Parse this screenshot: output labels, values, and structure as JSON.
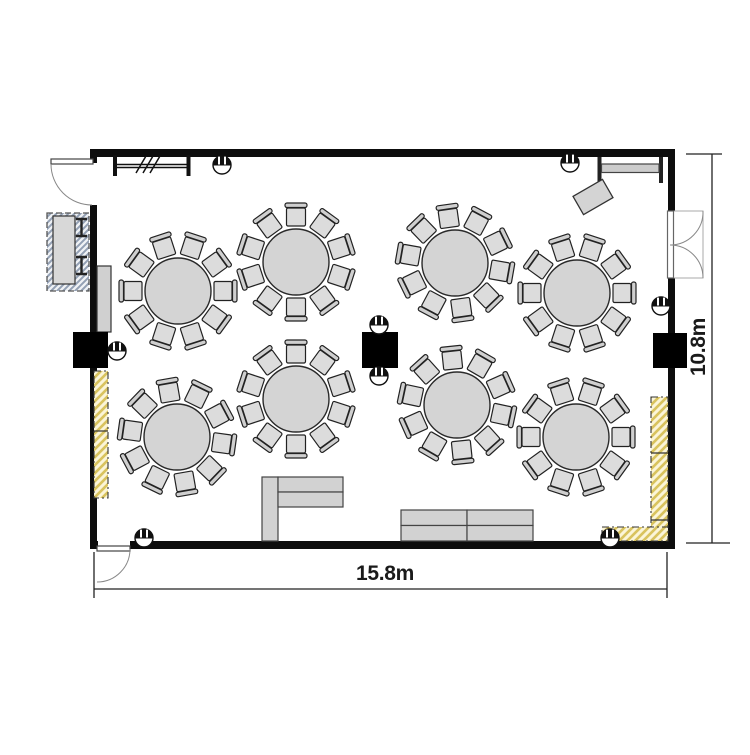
{
  "dimensions": {
    "width_label": "15.8m",
    "height_label": "10.8m"
  },
  "summary": {
    "round_tables": 8,
    "chairs_per_table": 10
  },
  "colors": {
    "wall": "#0d0d0d",
    "table_fill": "#d4d4d4",
    "chair_fill": "#dcdcdc",
    "chair_back_fill": "#cfcfcf",
    "sofa_fill": "#d2d2d2",
    "outline": "#222222",
    "yellow_hatch_bg": "#fbf5d8",
    "yellow_hatch_line": "#d9c35e",
    "blue_hatch_bg": "#f0f2f5",
    "blue_hatch_line": "#93a0b4"
  },
  "plan": {
    "canvas": {
      "w": 750,
      "h": 750
    },
    "walls": [
      {
        "x": 90,
        "y": 149,
        "w": 585,
        "h": 8
      },
      {
        "x": 90,
        "y": 149,
        "w": 7,
        "h": 14
      },
      {
        "x": 90,
        "y": 205,
        "w": 7,
        "h": 344
      },
      {
        "x": 90,
        "y": 541,
        "w": 8,
        "h": 8
      },
      {
        "x": 130,
        "y": 541,
        "w": 545,
        "h": 8
      },
      {
        "x": 668,
        "y": 149,
        "w": 7,
        "h": 62
      },
      {
        "x": 668,
        "y": 278,
        "w": 7,
        "h": 271
      }
    ],
    "columns": [
      {
        "x": 73,
        "y": 332,
        "w": 35,
        "h": 36
      },
      {
        "x": 362,
        "y": 332,
        "w": 36,
        "h": 36
      },
      {
        "x": 653,
        "y": 333,
        "w": 34,
        "h": 35
      }
    ],
    "shapes": [
      {
        "name": "partition-symbol-lines",
        "type": "path",
        "d": "M115 164.5 H189 M115 167.5 H189",
        "stroke": "#111",
        "sw": 1.4
      },
      {
        "name": "partition-symbol-endbar",
        "type": "rect",
        "x": 113,
        "y": 155,
        "w": 4,
        "h": 21,
        "fill": "#111"
      },
      {
        "name": "partition-symbol-endbar",
        "type": "rect",
        "x": 186.5,
        "y": 155,
        "w": 4,
        "h": 21,
        "fill": "#111"
      },
      {
        "name": "partition-symbol-slashes",
        "type": "path",
        "d": "M136 173 L146 156 M143 173 L153 156 M150 173 L160 156",
        "stroke": "#111",
        "sw": 1.5
      },
      {
        "name": "beam-symbol-endbar",
        "type": "rect",
        "x": 597.5,
        "y": 157,
        "w": 4,
        "h": 26,
        "fill": "#222"
      },
      {
        "name": "beam-symbol-endbar",
        "type": "rect",
        "x": 659,
        "y": 157,
        "w": 4,
        "h": 26,
        "fill": "#222"
      },
      {
        "name": "beam-symbol-band",
        "type": "rect",
        "x": 601.5,
        "y": 164,
        "w": 57.5,
        "h": 8.5,
        "fill": "#cccccc",
        "stroke": "#444",
        "sw": 1.2
      },
      {
        "name": "angled-side-table",
        "type": "rect",
        "x": 576,
        "y": 186.5,
        "w": 34,
        "h": 21,
        "fill": "#d4d4d4",
        "stroke": "#333",
        "sw": 1.3,
        "rotate": [
          -30,
          593,
          197
        ]
      },
      {
        "name": "service-unit-hatch",
        "type": "rect",
        "x": 47,
        "y": 213,
        "w": 42,
        "h": 78,
        "fill": "pattern:blue",
        "stroke": "#555",
        "sw": 1.3,
        "dash": "6 3"
      },
      {
        "name": "service-unit-body",
        "type": "rect",
        "x": 53,
        "y": 216,
        "w": 22,
        "h": 68,
        "fill": "#d8d8d8",
        "stroke": "#333",
        "sw": 1.2
      },
      {
        "name": "service-unit-bracket",
        "type": "path",
        "d": "M76 219 H87 M81.5 219 V236 M76 236 H87",
        "stroke": "#222",
        "sw": 2.4
      },
      {
        "name": "service-unit-bracket",
        "type": "path",
        "d": "M76 257 H87 M81.5 257 V274 M76 274 H87",
        "stroke": "#222",
        "sw": 2.4
      },
      {
        "name": "buffet-counter",
        "type": "rect",
        "x": 97,
        "y": 266,
        "w": 14,
        "h": 66,
        "fill": "#d0d0d0",
        "stroke": "#333",
        "sw": 1.2
      },
      {
        "name": "curtain-strip-left",
        "type": "rect",
        "x": 94,
        "y": 371,
        "w": 14,
        "h": 127,
        "fill": "pattern:yellow",
        "stroke": "#333",
        "sw": 1.1,
        "dash": "7 3 2 3"
      },
      {
        "name": "curtain-strip-divider",
        "type": "line",
        "x1": 94,
        "y1": 431,
        "x2": 108,
        "y2": 431,
        "stroke": "#333",
        "sw": 1.2
      },
      {
        "name": "curtain-strip-right",
        "type": "rect",
        "x": 651,
        "y": 397,
        "w": 17,
        "h": 136,
        "fill": "pattern:yellow",
        "stroke": "#333",
        "sw": 1.1,
        "dash": "7 3 2 3"
      },
      {
        "name": "curtain-strip-divider",
        "type": "line",
        "x1": 651,
        "y1": 453,
        "x2": 668,
        "y2": 453,
        "stroke": "#333",
        "sw": 1.2
      },
      {
        "name": "curtain-strip-divider",
        "type": "line",
        "x1": 651,
        "y1": 520,
        "x2": 668,
        "y2": 520,
        "stroke": "#333",
        "sw": 1.2
      },
      {
        "name": "curtain-strip-bottom",
        "type": "rect",
        "x": 602,
        "y": 527,
        "w": 66,
        "h": 14,
        "fill": "pattern:yellow",
        "stroke": "#333",
        "sw": 1.1,
        "dash": "7 3 2 3"
      },
      {
        "name": "l-sofa-segment",
        "type": "rect",
        "x": 262,
        "y": 477,
        "w": 16,
        "h": 64,
        "fill": "#d2d2d2",
        "stroke": "#444",
        "sw": 1.2
      },
      {
        "name": "l-sofa-segment",
        "type": "rect",
        "x": 278,
        "y": 477,
        "w": 65,
        "h": 15,
        "fill": "#d2d2d2",
        "stroke": "#444",
        "sw": 1.2
      },
      {
        "name": "l-sofa-segment",
        "type": "rect",
        "x": 278,
        "y": 492,
        "w": 65,
        "h": 15,
        "fill": "#d2d2d2",
        "stroke": "#444",
        "sw": 1.2
      },
      {
        "name": "double-sofa-segment",
        "type": "rect",
        "x": 401,
        "y": 510,
        "w": 66,
        "h": 15.5,
        "fill": "#d2d2d2",
        "stroke": "#444",
        "sw": 1.2
      },
      {
        "name": "double-sofa-segment",
        "type": "rect",
        "x": 467,
        "y": 510,
        "w": 66,
        "h": 15.5,
        "fill": "#d2d2d2",
        "stroke": "#444",
        "sw": 1.2
      },
      {
        "name": "double-sofa-segment",
        "type": "rect",
        "x": 401,
        "y": 525.5,
        "w": 66,
        "h": 15.5,
        "fill": "#d2d2d2",
        "stroke": "#444",
        "sw": 1.2
      },
      {
        "name": "double-sofa-segment",
        "type": "rect",
        "x": 467,
        "y": 525.5,
        "w": 66,
        "h": 15.5,
        "fill": "#d2d2d2",
        "stroke": "#444",
        "sw": 1.2
      },
      {
        "name": "entry-door-leaf",
        "type": "rect",
        "x": 51,
        "y": 159,
        "w": 42,
        "h": 5,
        "fill": "#ffffff",
        "stroke": "#444",
        "sw": 1.2
      },
      {
        "name": "entry-door-swing",
        "type": "path",
        "d": "M51 164 A41 41 0 0 0 92 205",
        "stroke": "#888",
        "sw": 1
      },
      {
        "name": "exit-door-leaf",
        "type": "rect",
        "x": 97,
        "y": 546,
        "w": 33,
        "h": 5,
        "fill": "#ffffff",
        "stroke": "#444",
        "sw": 1.2
      },
      {
        "name": "exit-door-swing",
        "type": "path",
        "d": "M130 549 A33 33 0 0 1 97 582",
        "stroke": "#888",
        "sw": 1
      },
      {
        "name": "double-door-frame",
        "type": "rect",
        "x": 668.5,
        "y": 211,
        "w": 34.5,
        "h": 67,
        "fill": "#ffffff",
        "stroke": "#aaa",
        "sw": 1
      },
      {
        "name": "double-door-leaves",
        "type": "rect",
        "x": 667.5,
        "y": 211,
        "w": 6,
        "h": 67,
        "fill": "#ffffff",
        "stroke": "#666",
        "sw": 1.2
      },
      {
        "name": "double-door-swing",
        "type": "path",
        "d": "M703 211 A33 33 0 0 1 670 245",
        "stroke": "#888",
        "sw": 1
      },
      {
        "name": "double-door-swing",
        "type": "path",
        "d": "M703 278 A33 33 0 0 0 670 245",
        "stroke": "#888",
        "sw": 1
      },
      {
        "name": "dimension-line-width",
        "type": "path",
        "d": "M94 552 V598 M667 552 V598 M94 589 H667",
        "stroke": "#222",
        "sw": 1.3
      },
      {
        "name": "dimension-line-height",
        "type": "path",
        "d": "M712 154 V543 M686 154 H722 M686 543 H730",
        "stroke": "#222",
        "sw": 1.3
      }
    ],
    "fixtures": [
      {
        "cx": 222,
        "cy": 165
      },
      {
        "cx": 570,
        "cy": 163
      },
      {
        "cx": 117,
        "cy": 351
      },
      {
        "cx": 661,
        "cy": 306
      },
      {
        "cx": 379,
        "cy": 325
      },
      {
        "cx": 379,
        "cy": 376
      },
      {
        "cx": 144,
        "cy": 538
      },
      {
        "cx": 610,
        "cy": 538
      }
    ],
    "tables": [
      {
        "cx": 178,
        "cy": 291,
        "r": 33,
        "chairs": 10,
        "start": -72
      },
      {
        "cx": 296,
        "cy": 262,
        "r": 33,
        "chairs": 10,
        "start": -54
      },
      {
        "cx": 455,
        "cy": 263,
        "r": 33,
        "chairs": 10,
        "start": -62
      },
      {
        "cx": 577,
        "cy": 293,
        "r": 33,
        "chairs": 10,
        "start": -72
      },
      {
        "cx": 177,
        "cy": 437,
        "r": 33,
        "chairs": 10,
        "start": -64
      },
      {
        "cx": 296,
        "cy": 399,
        "r": 33,
        "chairs": 10,
        "start": -54
      },
      {
        "cx": 457,
        "cy": 405,
        "r": 33,
        "chairs": 10,
        "start": -60
      },
      {
        "cx": 576,
        "cy": 437,
        "r": 33,
        "chairs": 10,
        "start": -72
      }
    ]
  }
}
